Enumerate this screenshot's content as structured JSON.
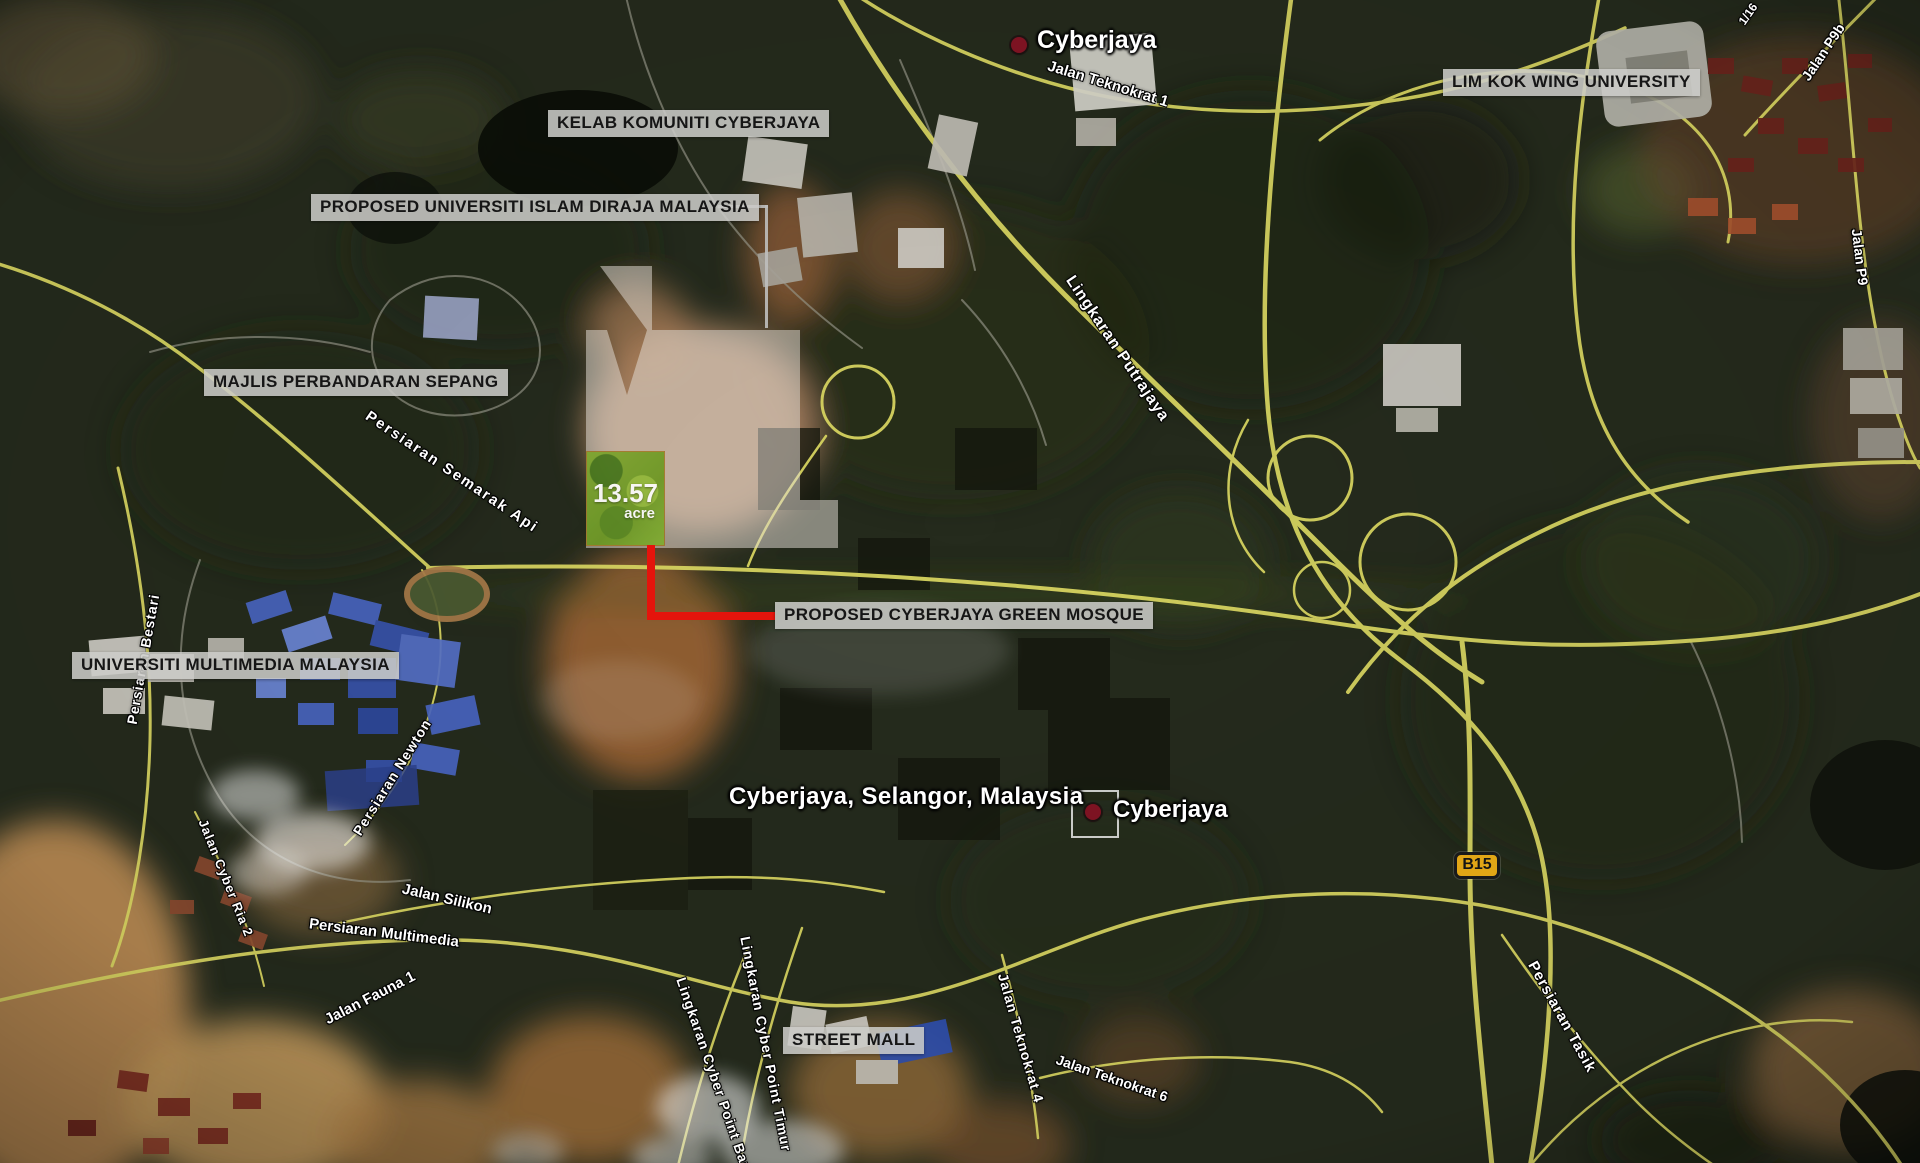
{
  "map": {
    "location_caption": "Cyberjaya, Selangor, Malaysia",
    "plot": {
      "area": "13.57",
      "unit": "acre"
    },
    "route_badge": "B15"
  },
  "colors": {
    "annotation_red": "#e4140c",
    "plot_green": "#74a226",
    "road_yellow": "#d8d561",
    "label_background": "#cbcbc8",
    "marker_dot": "#7d1322",
    "route_badge_yellow": "#e2a616"
  },
  "boxed_labels": [
    {
      "id": "kelab-komuniti-cyberjaya",
      "text": "KELAB KOMUNITI CYBERJAYA",
      "x": 548,
      "y": 110
    },
    {
      "id": "proposed-universiti-islam-diraja-malaysia",
      "text": "PROPOSED UNIVERSITI ISLAM DIRAJA MALAYSIA",
      "x": 311,
      "y": 194
    },
    {
      "id": "majlis-perbandaran-sepang",
      "text": "MAJLIS PERBANDARAN SEPANG",
      "x": 204,
      "y": 369
    },
    {
      "id": "lim-kok-wing-university",
      "text": "LIM KOK WING UNIVERSITY",
      "x": 1443,
      "y": 69
    },
    {
      "id": "universiti-multimedia-malaysia",
      "text": "UNIVERSITI MULTIMEDIA MALAYSIA",
      "x": 72,
      "y": 652
    },
    {
      "id": "proposed-cyberjaya-green-mosque",
      "text": "PROPOSED CYBERJAYA GREEN MOSQUE",
      "x": 775,
      "y": 602
    },
    {
      "id": "street-mall",
      "text": "STREET MALL",
      "x": 783,
      "y": 1027
    }
  ],
  "place_markers": [
    {
      "label": "Cyberjaya",
      "dot": {
        "x": 1019,
        "y": 45
      },
      "label_pos": {
        "x": 1037,
        "y": 26
      },
      "font": 25,
      "selected": false
    },
    {
      "label": "Cyberjaya",
      "dot": {
        "x": 1093,
        "y": 812
      },
      "label_pos": {
        "x": 1113,
        "y": 796
      },
      "font": 24,
      "selected": true
    }
  ],
  "road_labels": [
    {
      "text": "Jalan Teknokrat 1",
      "x": 1108,
      "y": 84,
      "rot": 17,
      "size": 15
    },
    {
      "text": "Lingkaran Putrajaya",
      "x": 1117,
      "y": 349,
      "rot": 56,
      "size": 16,
      "spacing": 1
    },
    {
      "text": "Persiaran Semarak Api",
      "x": 452,
      "y": 472,
      "rot": 34,
      "size": 15,
      "spacing": 2
    },
    {
      "text": "Persiaran Bestari",
      "x": 143,
      "y": 659,
      "rot": -80,
      "size": 14,
      "spacing": 1
    },
    {
      "text": "Persiaran Newton",
      "x": 392,
      "y": 777,
      "rot": -58,
      "size": 14,
      "spacing": 1
    },
    {
      "text": "Jalan Silikon",
      "x": 447,
      "y": 899,
      "rot": 13,
      "size": 15
    },
    {
      "text": "Persiaran Multimedia",
      "x": 384,
      "y": 933,
      "rot": 7,
      "size": 15
    },
    {
      "text": "Jalan Fauna 1",
      "x": 370,
      "y": 998,
      "rot": -27,
      "size": 15
    },
    {
      "text": "Jalan Cyber Ria 2",
      "x": 226,
      "y": 878,
      "rot": 68,
      "size": 13,
      "spacing": 1
    },
    {
      "text": "Lingkaran Cyber Point Timur",
      "x": 766,
      "y": 1044,
      "rot": 79,
      "size": 14,
      "spacing": 1
    },
    {
      "text": "Lingkaran Cyber Point Barat",
      "x": 716,
      "y": 1080,
      "rot": 71,
      "size": 14,
      "spacing": 1
    },
    {
      "text": "Jalan Teknokrat 4",
      "x": 1021,
      "y": 1038,
      "rot": 74,
      "size": 14,
      "spacing": 1
    },
    {
      "text": "Jalan Teknokrat 6",
      "x": 1112,
      "y": 1078,
      "rot": 19,
      "size": 14
    },
    {
      "text": "Jalan P9b",
      "x": 1823,
      "y": 52,
      "rot": -56,
      "size": 14
    },
    {
      "text": "Jalan P9",
      "x": 1860,
      "y": 257,
      "rot": 83,
      "size": 14
    },
    {
      "text": "1/16",
      "x": 1748,
      "y": 14,
      "rot": -55,
      "size": 12
    },
    {
      "text": "Persiaran Tasik",
      "x": 1562,
      "y": 1017,
      "rot": 61,
      "size": 15,
      "spacing": 1
    }
  ]
}
